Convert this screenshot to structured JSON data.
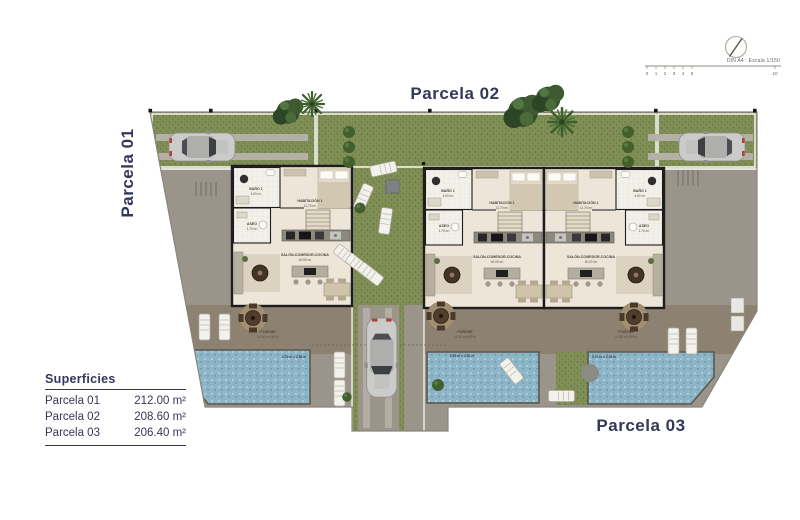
{
  "parcels": {
    "p1": "Parcela 01",
    "p2": "Parcela 02",
    "p3": "Parcela 03"
  },
  "title_block": {
    "scale_note": "DIN A4 : Escala 1/150",
    "ticks": [
      "0",
      "1",
      "2",
      "3",
      "4",
      "5",
      "10"
    ]
  },
  "superficies": {
    "title": "Superficies",
    "rows": [
      {
        "name": "Parcela 01",
        "area": "212.00 m²"
      },
      {
        "name": "Parcela 02",
        "area": "208.60 m²"
      },
      {
        "name": "Parcela 03",
        "area": "206.40 m²"
      }
    ]
  },
  "rooms": {
    "bano": {
      "name": "BAÑO 1",
      "area": "4.00 m²"
    },
    "aseo": {
      "name": "ASEO",
      "area": "1.70 m²"
    },
    "habitacion": {
      "name": "HABITACIÓN 1",
      "area": "11.70 m²"
    },
    "salon": {
      "name": "SALÓN-COMEDOR-COCINA",
      "area": "40.00 m²"
    },
    "porche": {
      "name": "PORCHE",
      "area": "14.50 m² (50%)"
    }
  },
  "pools": {
    "side": "4.70 m x 2.35 m",
    "center": "5.35 m x 2.30 m"
  },
  "colors": {
    "accent_navy": "#343759",
    "grass": "#7f8e55",
    "ground": "#9a948b",
    "terrace": "#8d8172",
    "pool": "#8cb5c8",
    "floor": "#ece5d8"
  }
}
